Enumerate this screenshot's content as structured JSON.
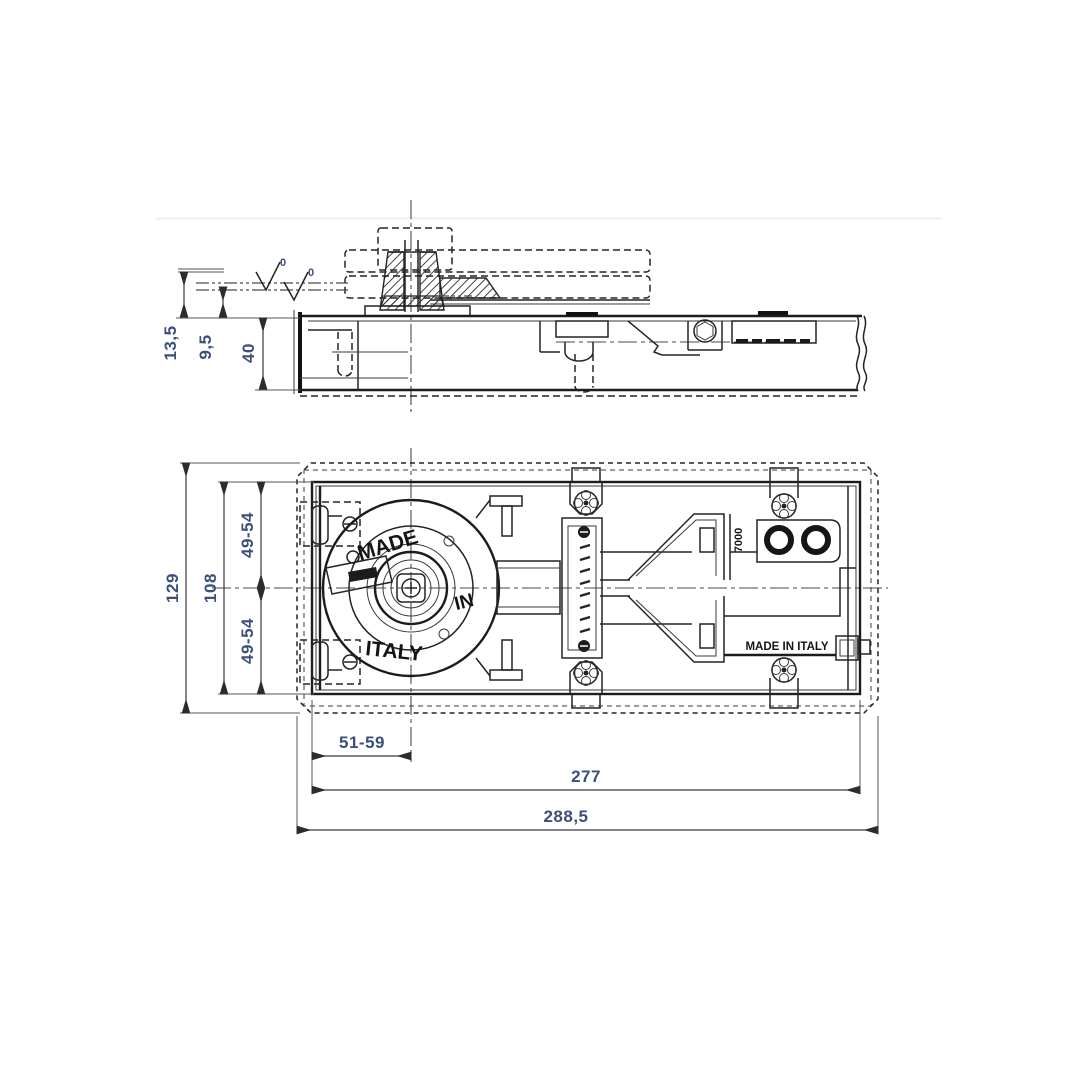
{
  "drawing": {
    "type": "technical-drawing",
    "subject": "floor-spring-door-closer-two-views",
    "colors": {
      "line": "#1f1f1f",
      "dimension_text": "#3c4e7a",
      "background": "#ffffff"
    },
    "side_view": {
      "dim_offset_axis": "13,5",
      "dim_offset_floor": "9,5",
      "dim_body_height": "40",
      "level_mark_left": "0",
      "level_mark_right": "0"
    },
    "plan_view": {
      "dim_box_height": "129",
      "dim_plate_height": "108",
      "dim_axis_top": "49-54",
      "dim_axis_bottom": "49-54",
      "dim_spindle_offset": "51-59",
      "dim_plate_length": "277",
      "dim_box_length": "288,5",
      "label_made": "MADE",
      "label_in": "IN",
      "label_italy": "ITALY",
      "label_model": "7000",
      "label_origin": "MADE IN ITALY"
    }
  }
}
